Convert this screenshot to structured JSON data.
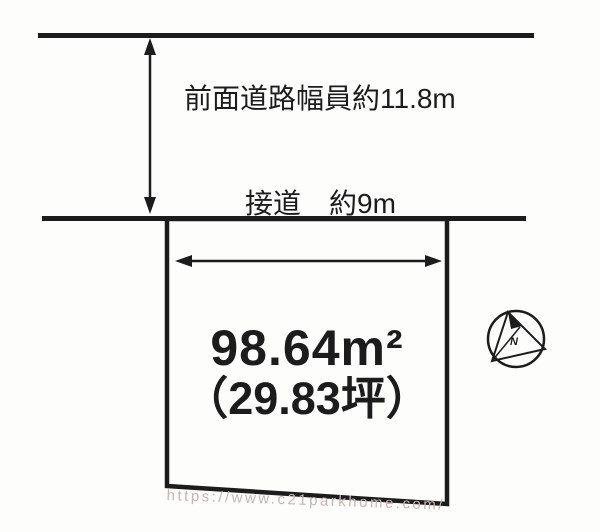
{
  "diagram_title": "land-plot-layout",
  "labels": {
    "road_width": "前面道路幅員約11.8m",
    "frontage": "接道　約9m"
  },
  "plot": {
    "area_sqm": "98.64m²",
    "area_tsubo": "（29.83坪）",
    "area_sqm_value": 98.64,
    "area_tsubo_value": 29.83
  },
  "measurements": {
    "front_road_width_m": 11.8,
    "frontage_m": 9
  },
  "compass": {
    "label": "N"
  },
  "watermark": {
    "text": "https://www.c21parkhome.com/"
  },
  "colors": {
    "line": "#1c1c1c",
    "background": "#fdfdfb",
    "watermark": "#c9b3b3"
  }
}
